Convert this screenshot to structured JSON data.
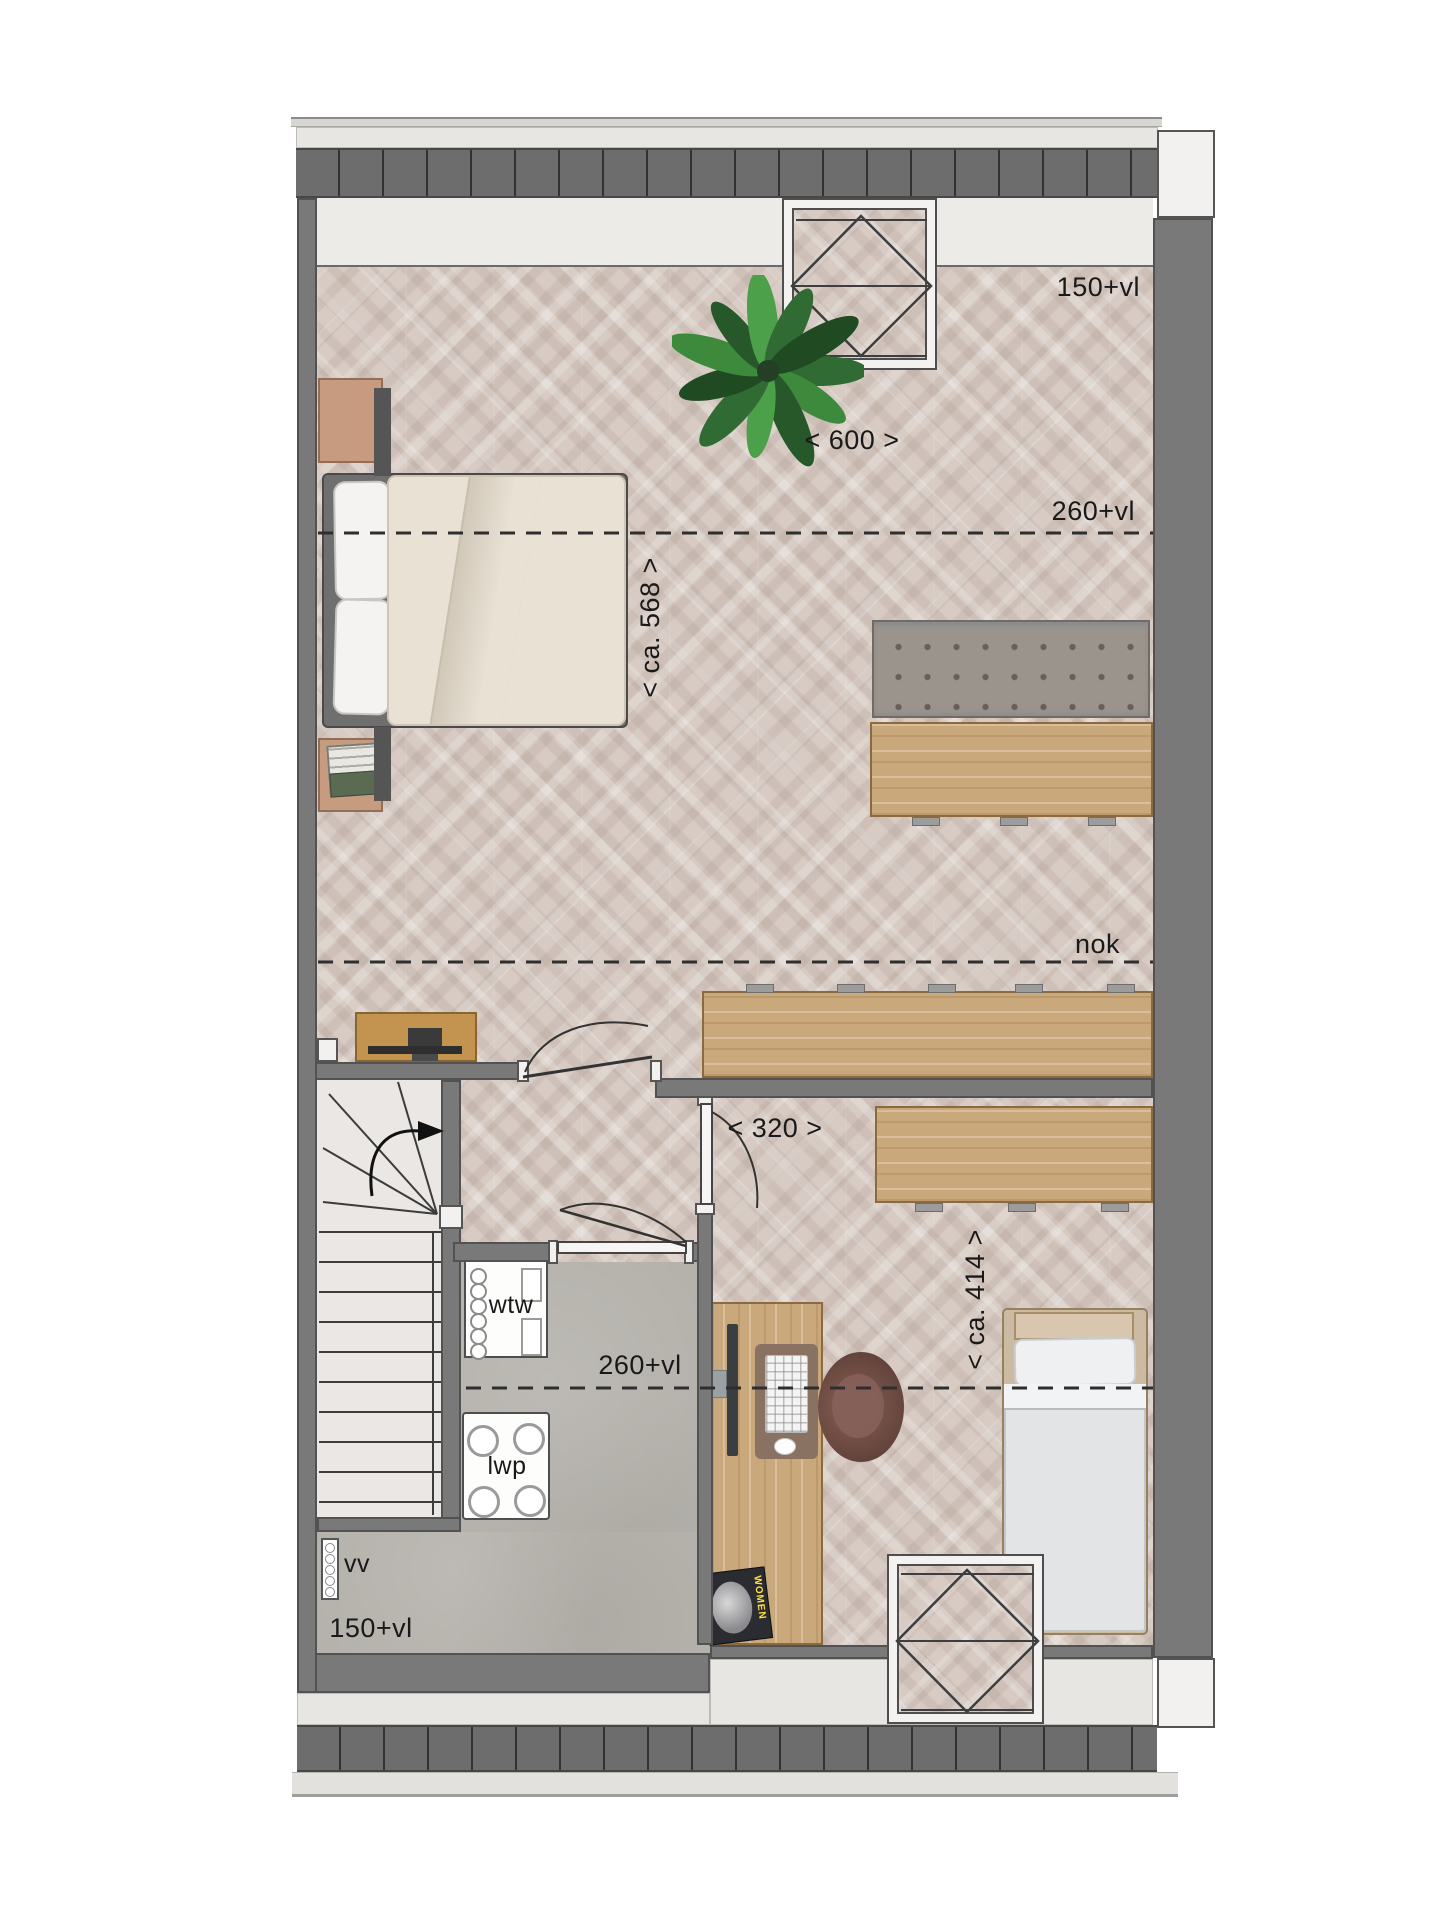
{
  "plan": {
    "height_labels": {
      "top_150": "150+vl",
      "top_260": "260+vl",
      "ridge": "nok",
      "mid_260": "260+vl",
      "bottom_150": "150+vl"
    },
    "dimension_labels": {
      "width_top": "< 600 >",
      "depth_left": "< ca. 568 >",
      "width_room2": "< 320 >",
      "depth_right": "< ca. 414 >"
    },
    "equipment_labels": {
      "heat_recovery_unit": "wtw",
      "heat_pump": "lwp",
      "radiator": "vv"
    },
    "magazine_title": "WOMEN",
    "icons": {
      "stairs_direction": "curved-arrow-right",
      "door_swing": "quarter-arc",
      "skylight_glazing": "diamond-cross"
    },
    "colors": {
      "wall": "#797979",
      "roof_band": "#6d6d6d",
      "floor_wood": "#d7cbc3",
      "floor_concrete": "#b5b2ac",
      "furniture_oak": "#c9a87c",
      "plant_green": "#3e8a3c",
      "label_text": "#191919"
    }
  }
}
